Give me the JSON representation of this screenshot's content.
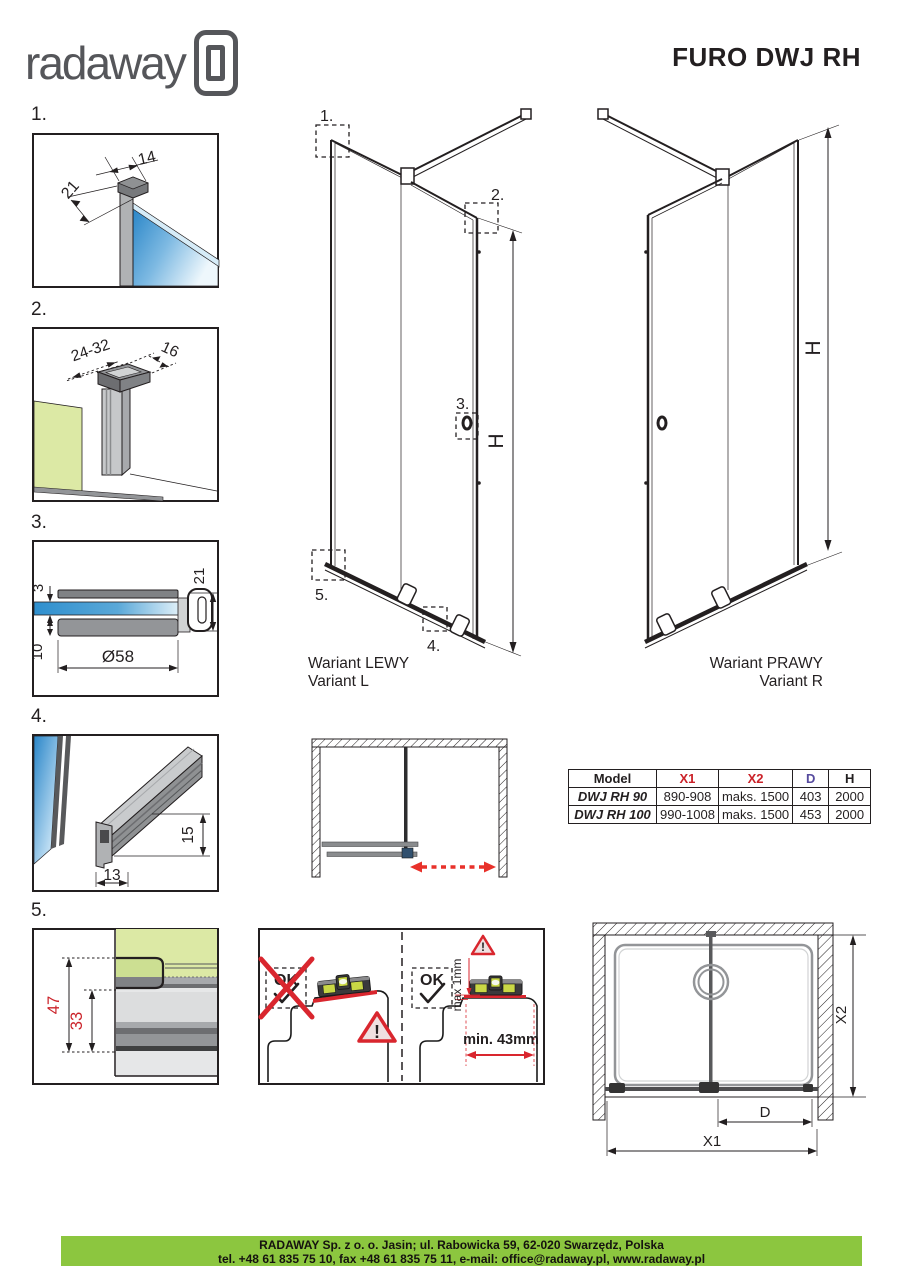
{
  "header": {
    "brand": "radaway",
    "title": "FURO DWJ RH"
  },
  "details": {
    "d1": {
      "label": "1.",
      "dim_width": "14",
      "dim_depth": "21"
    },
    "d2": {
      "label": "2.",
      "dim_range": "24-32",
      "dim_depth": "16"
    },
    "d3": {
      "label": "3.",
      "dim_glass": "3",
      "dim_plate": "10",
      "dim_diameter": "Ø58",
      "dim_height": "21"
    },
    "d4": {
      "label": "4.",
      "dim_height": "15",
      "dim_width": "13"
    },
    "d5": {
      "label": "5.",
      "dim_total": "47",
      "dim_inner": "33"
    }
  },
  "variant_left": {
    "callout_1": "1.",
    "callout_2": "2.",
    "callout_3": "3.",
    "callout_4": "4.",
    "callout_5": "5.",
    "height_label": "H",
    "caption_pl": "Wariant LEWY",
    "caption_en": "Variant L"
  },
  "variant_right": {
    "height_label": "H",
    "caption_pl": "Wariant PRAWY",
    "caption_en": "Variant R"
  },
  "spec_table": {
    "col_model": "Model",
    "col_x1": "X1",
    "col_x2": "X2",
    "col_d": "D",
    "col_h": "H",
    "rows": [
      {
        "model": "DWJ RH 90",
        "x1": "890-908",
        "x2": "maks. 1500",
        "d": "403",
        "h": "2000"
      },
      {
        "model": "DWJ RH 100",
        "x1": "990-1008",
        "x2": "maks. 1500",
        "d": "453",
        "h": "2000"
      }
    ]
  },
  "installation": {
    "ok_wrong": "OK",
    "ok_right": "OK",
    "max_label": "max 1mm",
    "min_label": "min. 43mm",
    "warning_mark": "!"
  },
  "front_view": {
    "dim_x1": "X1",
    "dim_x2": "X2",
    "dim_d": "D"
  },
  "footer": {
    "line1": "RADAWAY Sp. z o. o. Jasin; ul. Rabowicka 59, 62-020 Swarzędz, Polska",
    "line2": "tel. +48 61 835 75 10, fax +48 61 835 75 11, e-mail: office@radaway.pl, www.radaway.pl"
  },
  "colors": {
    "accent_green": "#8cc63f",
    "wall_green": "#dce9a5",
    "glass_blue": "#2f8fce",
    "dim_red": "#cb2229",
    "warn_red": "#d9262e",
    "dim_purple": "#564a9e"
  }
}
